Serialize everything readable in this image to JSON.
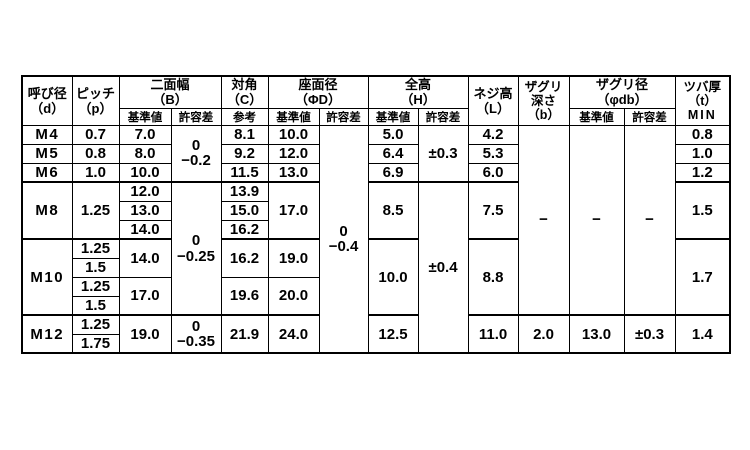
{
  "meta": {
    "background_color": "#ffffff",
    "line_color": "#000000",
    "text_color": "#000000"
  },
  "header": {
    "nominal_dia": {
      "line1": "呼び径",
      "line2": "（d）"
    },
    "pitch": {
      "line1": "ピッチ",
      "line2": "（p）"
    },
    "width_across_flats": {
      "line1": "二面幅",
      "line2": "（B）",
      "std": "基準値",
      "tol": "許容差"
    },
    "across_corners": {
      "line1": "対角",
      "line2": "（C）",
      "ref": "参考"
    },
    "bearing_surface_dia": {
      "line1": "座面径",
      "line2": "（ΦD）",
      "std": "基準値",
      "tol": "許容差"
    },
    "overall_height": {
      "line1": "全高",
      "line2": "（H）",
      "std": "基準値",
      "tol": "許容差"
    },
    "thread_height": {
      "line1": "ネジ高",
      "line2": "（L）"
    },
    "counterbore_depth": {
      "line1": "ザグリ",
      "line2": "深さ",
      "line3": "（b）"
    },
    "counterbore_dia": {
      "line1": "ザグリ径",
      "line2": "（φdb）",
      "std": "基準値",
      "tol": "許容差"
    },
    "flange_thickness": {
      "line1": "ツバ厚",
      "line2": "（t）",
      "line3": "MIN"
    }
  },
  "rows": {
    "m4": {
      "d": "M4",
      "p": "0.7",
      "B": "7.0",
      "C": "8.1",
      "D": "10.0",
      "H": "5.0",
      "L": "4.2",
      "t": "0.8"
    },
    "m5": {
      "d": "M5",
      "p": "0.8",
      "B": "8.0",
      "C": "9.2",
      "D": "12.0",
      "H": "6.4",
      "L": "5.3",
      "t": "1.0"
    },
    "m6": {
      "d": "M6",
      "p": "1.0",
      "B": "10.0",
      "C": "11.5",
      "D": "13.0",
      "H": "6.9",
      "L": "6.0",
      "t": "1.2"
    },
    "m8": {
      "d": "M8",
      "p": "1.25",
      "B1": "12.0",
      "B2": "13.0",
      "B3": "14.0",
      "C1": "13.9",
      "C2": "15.0",
      "C3": "16.2",
      "D": "17.0",
      "H": "8.5",
      "L": "7.5",
      "t": "1.5"
    },
    "m10": {
      "d": "M10",
      "p1": "1.25",
      "p2": "1.5",
      "p3": "1.25",
      "p4": "1.5",
      "B_upper": "14.0",
      "B_lower": "17.0",
      "C_upper": "16.2",
      "C_lower": "19.6",
      "D_upper": "19.0",
      "D_lower": "20.0",
      "H": "10.0",
      "L": "8.8",
      "t": "1.7"
    },
    "m12": {
      "d": "M12",
      "p1": "1.25",
      "p2": "1.75",
      "B": "19.0",
      "C": "21.9",
      "D": "24.0",
      "H": "12.5",
      "L": "11.0",
      "b": "2.0",
      "db_std": "13.0",
      "db_tol": "±0.3",
      "t": "1.4"
    }
  },
  "tolerances": {
    "B_m4_m6": {
      "line1": "0",
      "line2": "−0.2"
    },
    "B_m8_m10": {
      "line1": "0",
      "line2": "−0.25"
    },
    "B_m12": {
      "line1": "0",
      "line2": "−0.35"
    },
    "D_all": {
      "line1": "0",
      "line2": "−0.4"
    },
    "H_m4_m6": "±0.3",
    "H_m8_m12": "±0.4"
  },
  "empty_marks": {
    "b": "−",
    "db_std": "−",
    "db_tol": "−"
  }
}
